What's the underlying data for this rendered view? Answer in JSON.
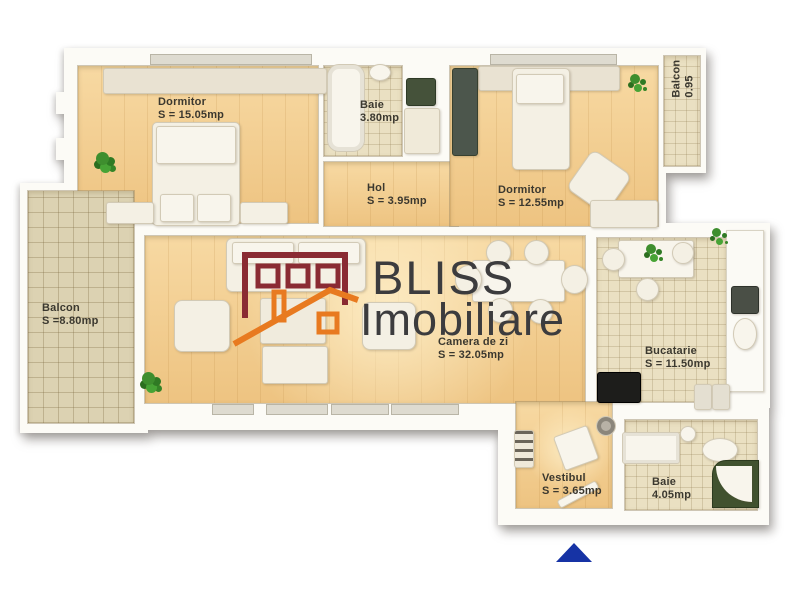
{
  "title": "Apartment floor plan",
  "brand": {
    "line1": "BLISS",
    "line2": "Imobiliare",
    "logo_icon": "house-logo",
    "colors": {
      "building": "#8a2b33",
      "roof": "#e87a20",
      "text": "#3c3c3e"
    }
  },
  "rooms": [
    {
      "name": "Dormitor",
      "area": "S = 15.05mp"
    },
    {
      "name": "Baie",
      "area": "3.80mp"
    },
    {
      "name": "Hol",
      "area": "S = 3.95mp"
    },
    {
      "name": "Dormitor",
      "area": "S = 12.55mp"
    },
    {
      "name": "Balcon",
      "area": "0.95"
    },
    {
      "name": "Balcon",
      "area": "S =8.80mp"
    },
    {
      "name": "Camera de zi",
      "area": "S = 32.05mp"
    },
    {
      "name": "Bucatarie",
      "area": "S = 11.50mp"
    },
    {
      "name": "Vestibul",
      "area": "S = 3.65mp"
    },
    {
      "name": "Baie",
      "area": "4.05mp"
    }
  ],
  "entrance_marker": {
    "shape": "triangle-up",
    "color": "#1633a5"
  },
  "floor_colors": {
    "wood": "#f2cb8c",
    "tile": "#eae0c2",
    "balcony_tile": "#dcd2b2",
    "wall": "#fcfbf6"
  }
}
